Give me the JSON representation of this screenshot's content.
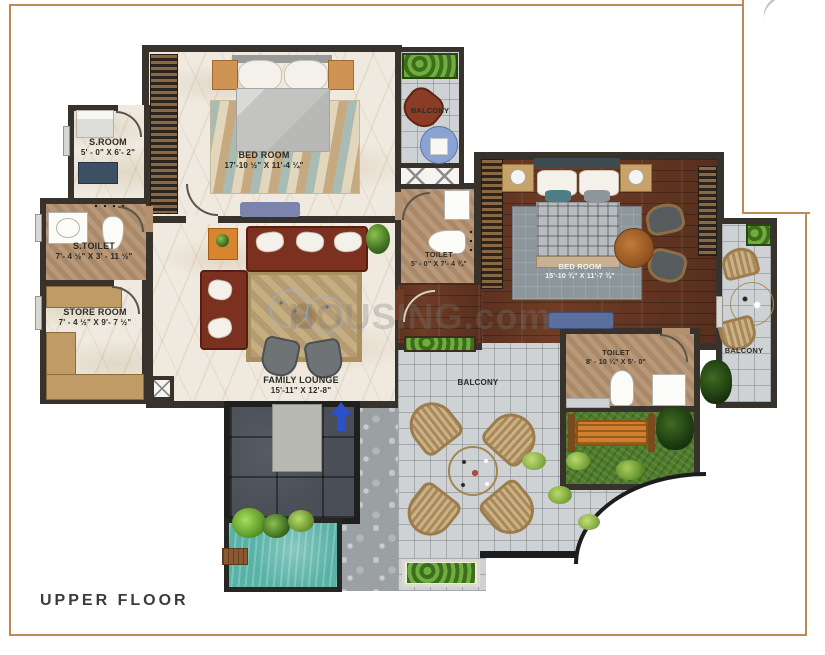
{
  "page": {
    "floor_label": "UPPER FLOOR",
    "watermark": "HOUSING.com"
  },
  "colors": {
    "frame_border": "#bd8a56",
    "wall": "#37332c",
    "marble_floor": "#efe9df",
    "toilet_floor": "#b3906f",
    "wood_floor": "#6f3c26",
    "balcony_tile": "#ced2d4",
    "lawn_green": "#4e7c2a",
    "pool_teal": "#58b2a6",
    "slate_dark": "#4a4f57",
    "accent_orange": "#d9842f",
    "sofa_maroon": "#7c3020",
    "arrow_blue": "#2b50cc"
  },
  "rooms": {
    "sroom": {
      "name": "S.ROOM",
      "dims": "5' - 0\" X 6'- 2\""
    },
    "stoilet": {
      "name": "S.TOILET",
      "dims": "7'- 4 ½\" X 3' - 11 ½\""
    },
    "store_room": {
      "name": "STORE ROOM",
      "dims": "7' - 4 ½\" X 9'- 7 ½\""
    },
    "bedroom1": {
      "name": "BED ROOM",
      "dims": "17'-10 ½\" X 11'-4 ¼\""
    },
    "balcony_top": {
      "name": "BALCONY"
    },
    "toilet_mid": {
      "name": "TOILET",
      "dims": "5' - 0\" X 7'- 4 ¾\""
    },
    "bedroom2": {
      "name": "BED ROOM",
      "dims": "15'-10 ¾\" X 11'-7 ¾\""
    },
    "balcony_right": {
      "name": "BALCONY"
    },
    "toilet_right": {
      "name": "TOILET",
      "dims": "8' - 10 ¼\" X 5'- 0\""
    },
    "family_lounge": {
      "name": "FAMILY LOUNGE",
      "dims": "15'-11\" X 12'-8\""
    },
    "balcony_main": {
      "name": "BALCONY"
    }
  }
}
